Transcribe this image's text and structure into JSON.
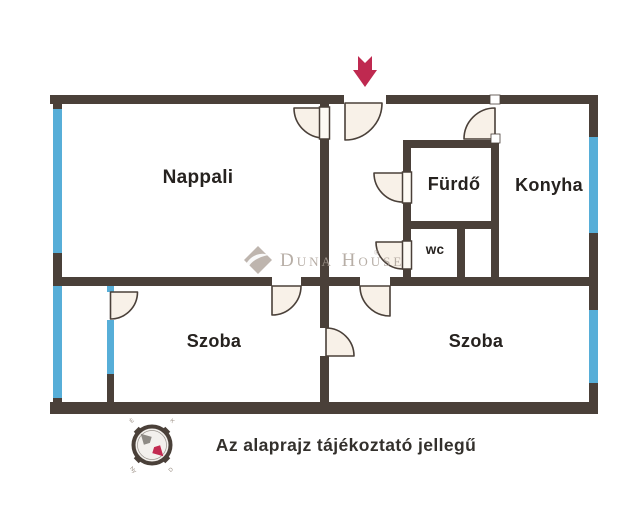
{
  "meta": {
    "type": "real-estate floor plan",
    "width_px": 640,
    "height_px": 518
  },
  "colors": {
    "wall": "#4a4039",
    "window": "#57aed8",
    "door_fill": "#f8f1e8",
    "leaf_fill": "#fdfaf4",
    "arrow": "#bf2950",
    "label": "#26221f",
    "caption": "#33302c",
    "watermark": "#aba097",
    "logo": "#b3a9a1",
    "compass_face": "#f3f0ed",
    "compass_tick": "#95897e",
    "needle_gray": "#8e8a85",
    "needle_red": "#c22a50"
  },
  "rooms": {
    "nappali": {
      "label": "Nappali"
    },
    "furdo": {
      "label": "Fürdő"
    },
    "konyha": {
      "label": "Konyha"
    },
    "wc": {
      "label": "wc"
    },
    "szoba_left": {
      "label": "Szoba"
    },
    "szoba_right": {
      "label": "Szoba"
    }
  },
  "caption": {
    "text": "Az alaprajz tájékoztató jellegű"
  },
  "watermark": {
    "text": "Duna House",
    "registered": "®"
  },
  "compass": {
    "icon": "compass-icon",
    "ticks": {
      "nw": "É",
      "ne": "K",
      "se": "D",
      "sw": "Ny"
    }
  },
  "entrance": {
    "icon": "down-arrow-icon"
  }
}
